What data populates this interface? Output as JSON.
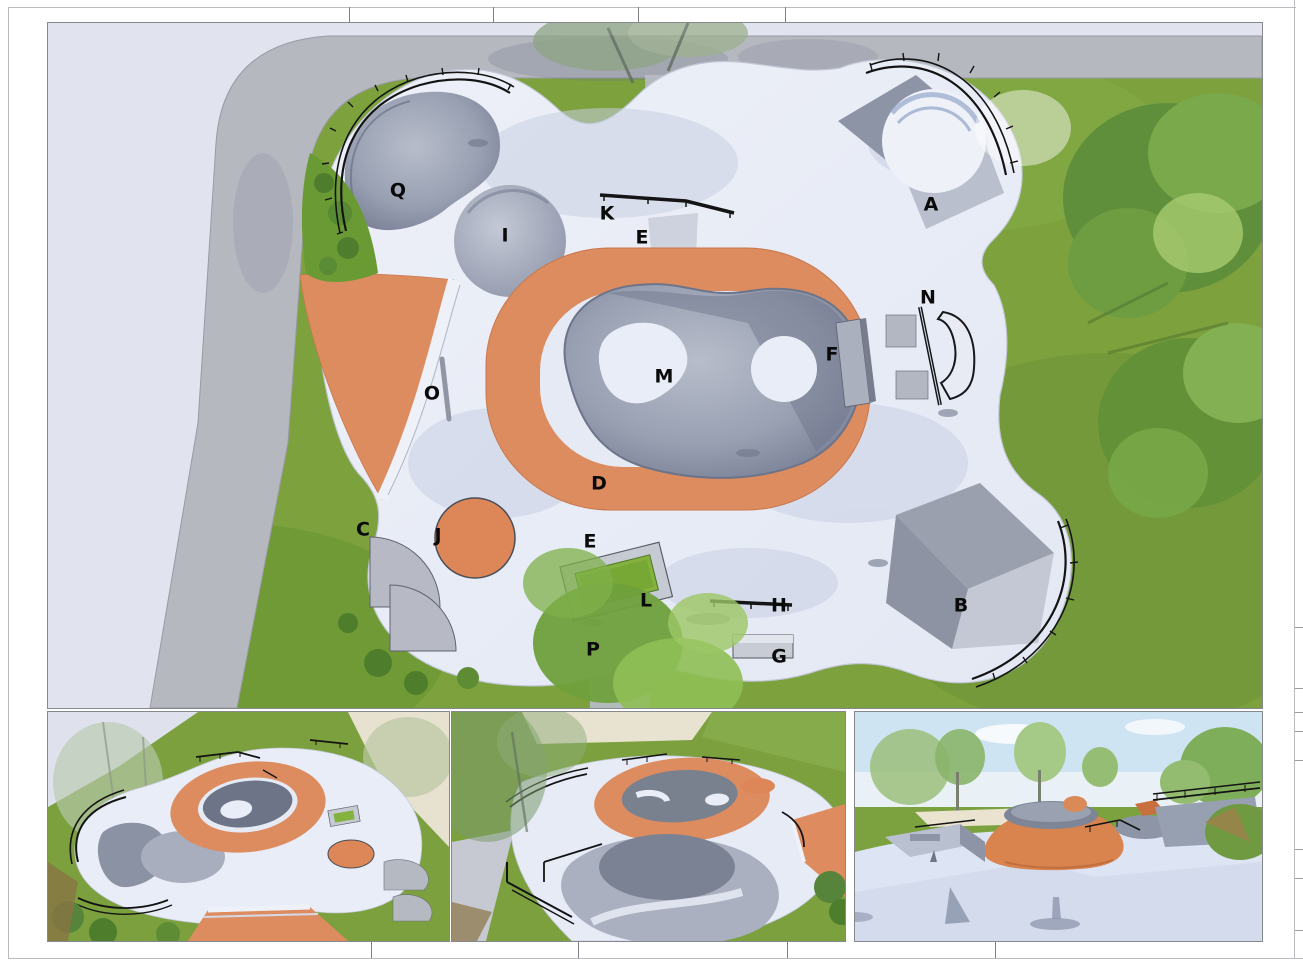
{
  "sheet": {
    "type": "skatepark-concept-design-sheet",
    "background": "#ffffff",
    "frame_color": "#b9bbc0"
  },
  "colors": {
    "grass": "#7ca13d",
    "grass_dark": "#639231",
    "road": "#e1e3ef",
    "sidewalk": "#b5b7bf",
    "concrete": "#e9edf7",
    "concrete_shadow": "#c9d0e2",
    "bowl_mid": "#9aa1b2",
    "bowl_dark": "#7a8196",
    "terracotta": "#dd8c60",
    "terracotta_dark": "#d07e4f",
    "rail_black": "#1a1a1a",
    "planter_green": "#83b23e",
    "sky": "#cfe4f2",
    "sand": "#e9e2cd",
    "tree_dark": "#55843a",
    "tree_mid": "#79a94a",
    "tree_light": "#a7cb70",
    "label": "#0a0a0a"
  },
  "plan": {
    "callouts": [
      {
        "letter": "Q",
        "x": 350,
        "y": 169
      },
      {
        "letter": "I",
        "x": 457,
        "y": 214
      },
      {
        "letter": "K",
        "x": 559,
        "y": 192
      },
      {
        "letter": "E",
        "x": 594,
        "y": 216
      },
      {
        "letter": "A",
        "x": 883,
        "y": 183
      },
      {
        "letter": "N",
        "x": 880,
        "y": 276
      },
      {
        "letter": "F",
        "x": 784,
        "y": 333
      },
      {
        "letter": "M",
        "x": 616,
        "y": 355
      },
      {
        "letter": "O",
        "x": 384,
        "y": 372
      },
      {
        "letter": "D",
        "x": 551,
        "y": 462
      },
      {
        "letter": "C",
        "x": 315,
        "y": 508
      },
      {
        "letter": "J",
        "x": 390,
        "y": 514
      },
      {
        "letter": "E",
        "x": 542,
        "y": 520
      },
      {
        "letter": "L",
        "x": 598,
        "y": 579
      },
      {
        "letter": "P",
        "x": 545,
        "y": 628
      },
      {
        "letter": "H",
        "x": 731,
        "y": 584
      },
      {
        "letter": "B",
        "x": 913,
        "y": 584
      },
      {
        "letter": "G",
        "x": 731,
        "y": 635
      }
    ]
  }
}
